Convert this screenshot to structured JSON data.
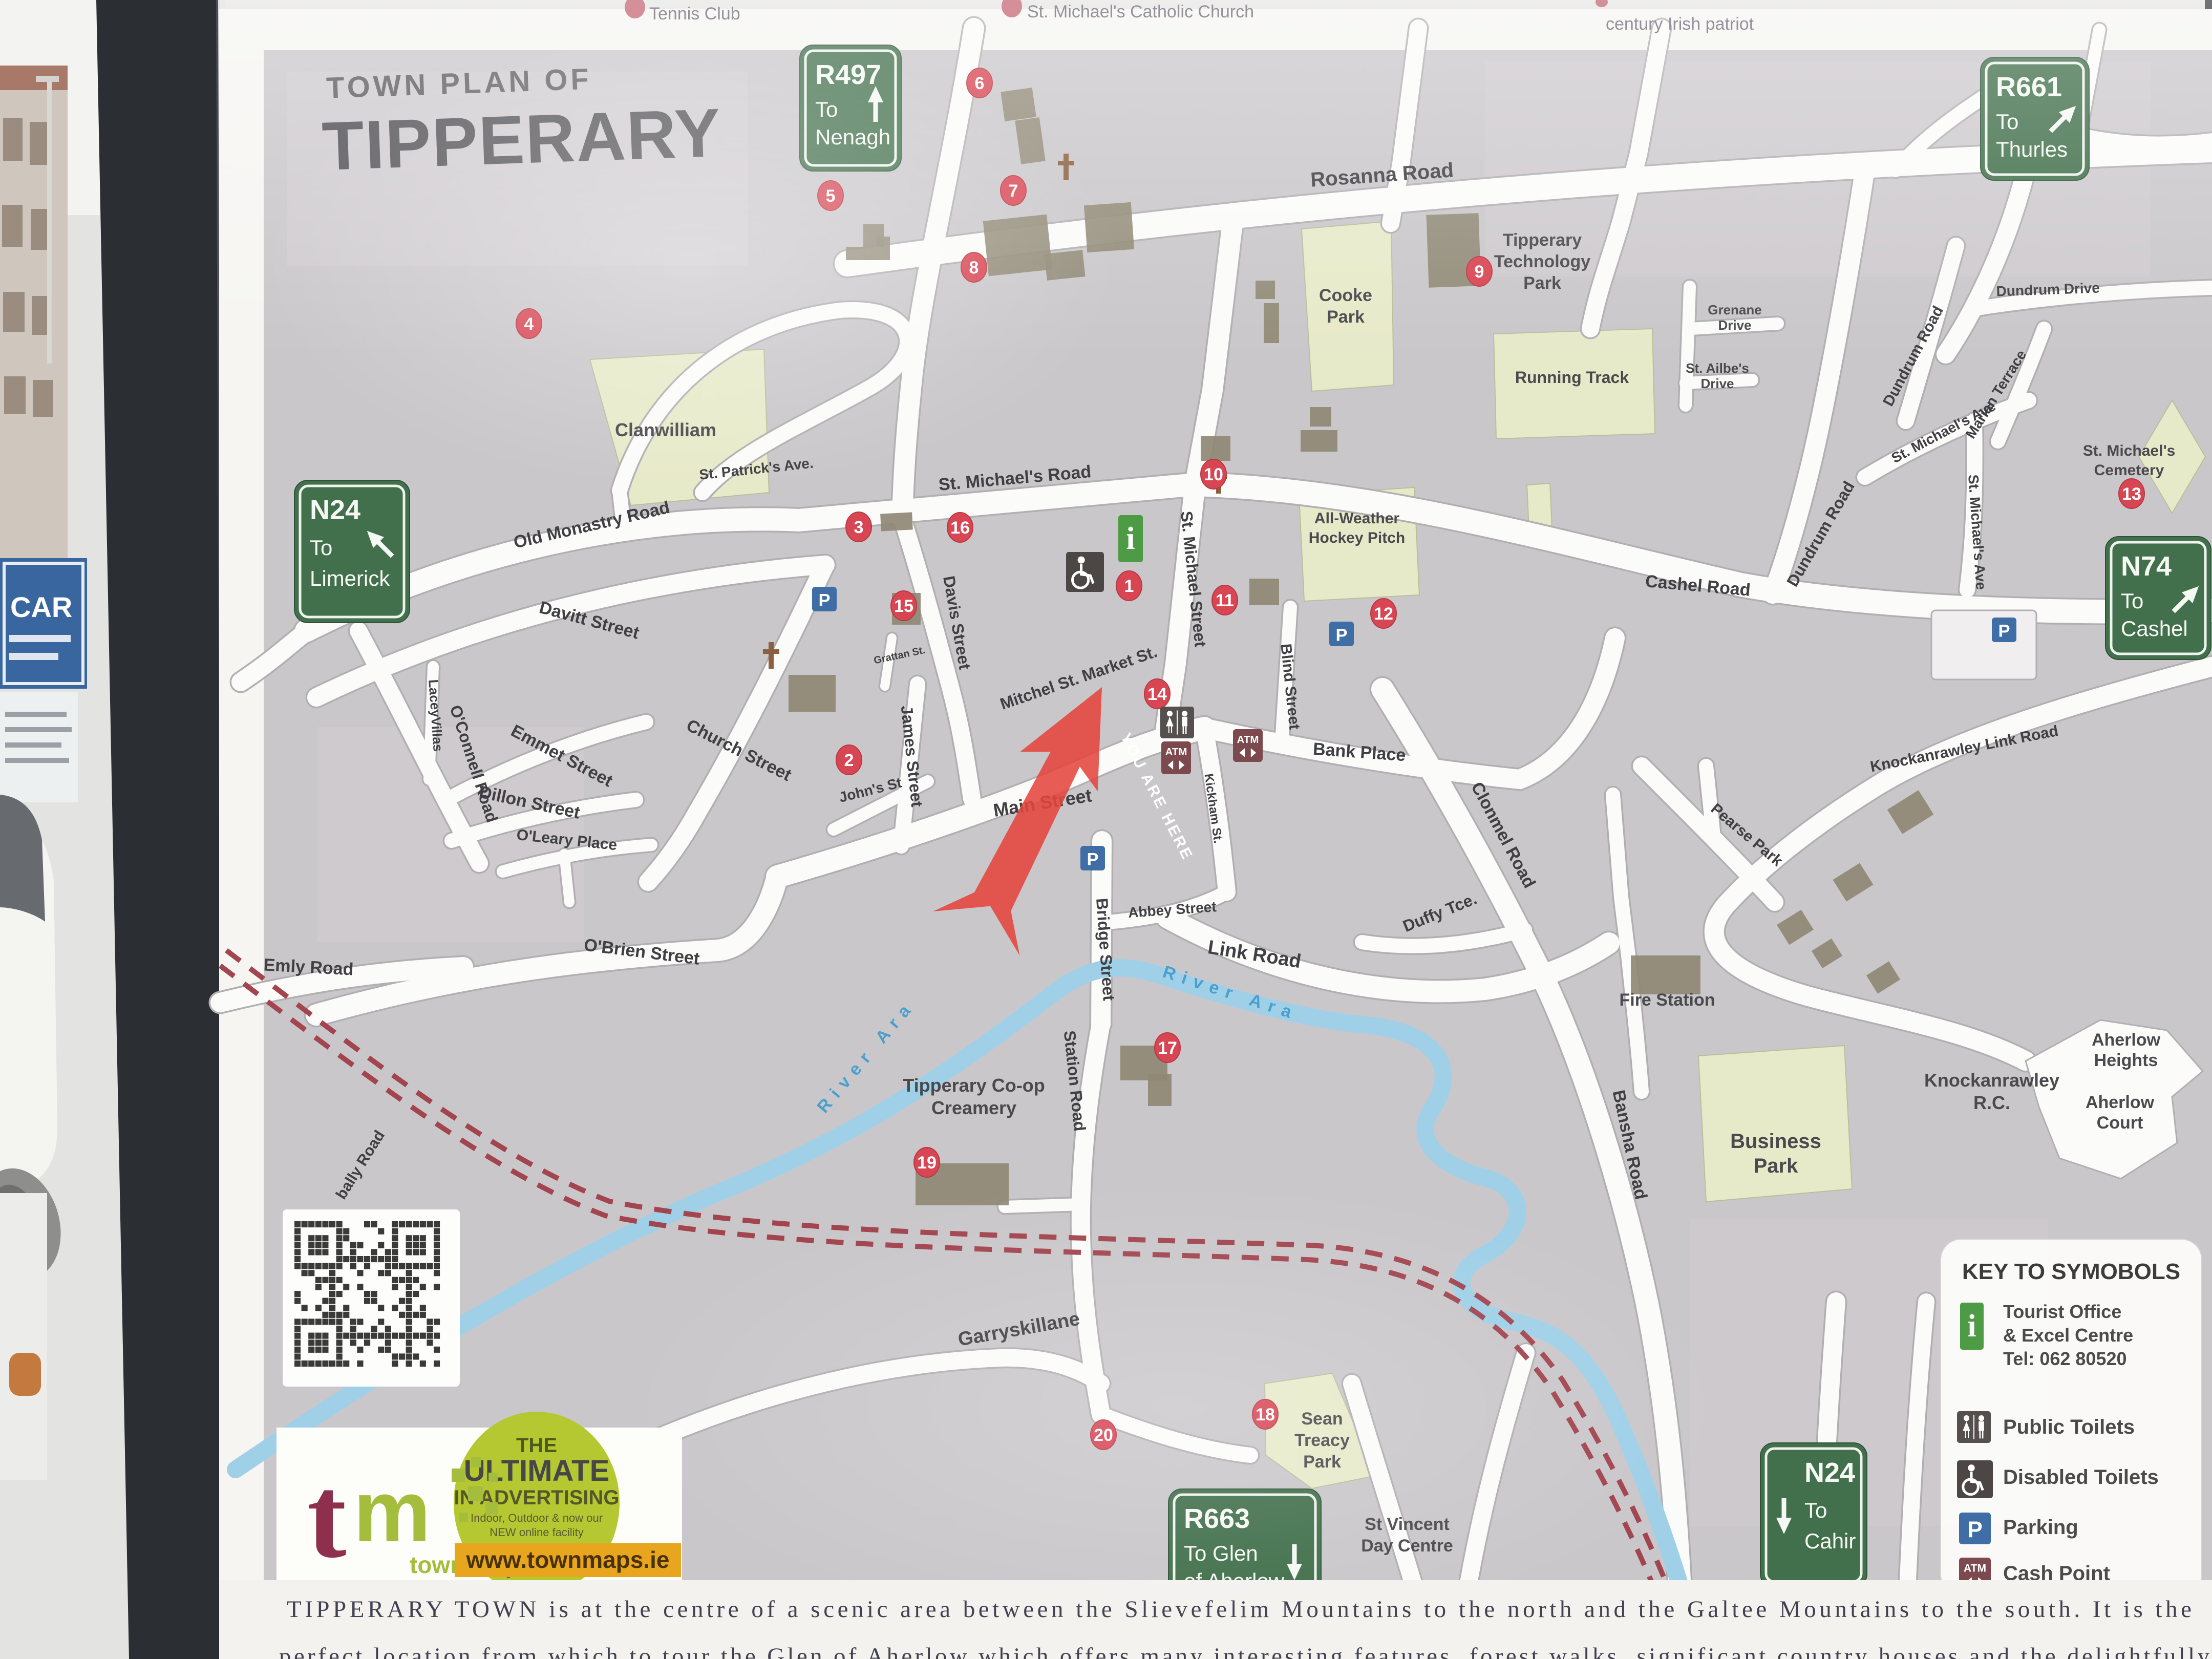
{
  "board": {
    "title_small": "TOWN PLAN OF",
    "title_large": "TIPPERARY",
    "top_cutoff_labels": [
      "Tennis Club",
      "St. Michael's Catholic Church",
      "century Irish patriot"
    ],
    "footer_line1": "TIPPERARY TOWN is at the centre of a scenic area between the Slievefelim Mountains to the north and the Galtee Mountains to the south. It is the",
    "footer_line2": "perfect location from which to tour the Glen of Aherlow which offers many interesting features, forest walks, significant country houses and the delightfully"
  },
  "you_are_here": "YOU ARE HERE",
  "road_signs": [
    {
      "ref": "R497",
      "dest": [
        "To",
        "Nenagh"
      ]
    },
    {
      "ref": "R661",
      "dest": [
        "To",
        "Thurles"
      ]
    },
    {
      "ref": "N24",
      "dest": [
        "To",
        "Limerick"
      ]
    },
    {
      "ref": "N74",
      "dest": [
        "To",
        "Cashel"
      ]
    },
    {
      "ref": "R663",
      "dest": [
        "To Glen",
        "of Aherlow"
      ]
    },
    {
      "ref": "N24",
      "dest": [
        "To",
        "Cahir"
      ]
    }
  ],
  "streets": [
    {
      "name": "Rosanna Road"
    },
    {
      "name": "St. Patrick's Ave."
    },
    {
      "name": "St. Michael's Road"
    },
    {
      "name": "Old Monastry Road"
    },
    {
      "name": "Davitt Street"
    },
    {
      "name": "LaceyVillas"
    },
    {
      "name": "Church Street"
    },
    {
      "name": "Emmet Street"
    },
    {
      "name": "Dillon Street"
    },
    {
      "name": "O'Connell Road"
    },
    {
      "name": "O'Leary Place"
    },
    {
      "name": "O'Brien Street"
    },
    {
      "name": "Emly Road"
    },
    {
      "name": "bally Road"
    },
    {
      "name": "John's St"
    },
    {
      "name": "James Street"
    },
    {
      "name": "Grattan St."
    },
    {
      "name": "Davis Street"
    },
    {
      "name": "Main Street"
    },
    {
      "name": "Mitchel St. Market St."
    },
    {
      "name": "St. Michael Street"
    },
    {
      "name": "Blind Street"
    },
    {
      "name": "Bank Place"
    },
    {
      "name": "Bridge Street"
    },
    {
      "name": "Abbey Street"
    },
    {
      "name": "Link Road"
    },
    {
      "name": "Kickham St."
    },
    {
      "name": "Duffy Tce."
    },
    {
      "name": "Clonmel Road"
    },
    {
      "name": "Cashel Road"
    },
    {
      "name": "Knockanrawley Link Road"
    },
    {
      "name": "Pearse Park"
    },
    {
      "name": "Dundrum Road"
    },
    {
      "name": "Dundrum Road"
    },
    {
      "name": "Dundrum Drive"
    },
    {
      "name": "St. Michael's Ave"
    },
    {
      "name": "St. Michael's Ave"
    },
    {
      "name": "Marian Terrace"
    },
    {
      "name": "Station Road"
    },
    {
      "name": "Bansha Road"
    },
    {
      "name": "Garryskillane"
    }
  ],
  "landmarks": [
    {
      "lines": [
        "Clanwilliam"
      ]
    },
    {
      "lines": [
        "Cooke",
        "Park"
      ]
    },
    {
      "lines": [
        "Running Track"
      ]
    },
    {
      "lines": [
        "All-Weather",
        "Hockey Pitch"
      ]
    },
    {
      "lines": [
        "Tipperary",
        "Technology",
        "Park"
      ]
    },
    {
      "lines": [
        "St. Michael's",
        "Cemetery"
      ]
    },
    {
      "lines": [
        "Tipperary Co-op",
        "Creamery"
      ]
    },
    {
      "lines": [
        "Fire Station"
      ]
    },
    {
      "lines": [
        "Business",
        "Park"
      ]
    },
    {
      "lines": [
        "Knockanrawley",
        "R.C."
      ]
    },
    {
      "lines": [
        "Aherlow",
        "Heights"
      ]
    },
    {
      "lines": [
        "Aherlow",
        "Court"
      ]
    },
    {
      "lines": [
        "Sean",
        "Treacy",
        "Park"
      ]
    },
    {
      "lines": [
        "St Vincent",
        "Day Centre"
      ]
    },
    {
      "lines": [
        "Grenane",
        "Drive"
      ]
    },
    {
      "lines": [
        "St. Ailbe's",
        "Drive"
      ]
    }
  ],
  "river_labels": [
    "River Ara",
    "River Ara"
  ],
  "markers": [
    {
      "n": "1"
    },
    {
      "n": "2"
    },
    {
      "n": "3"
    },
    {
      "n": "4"
    },
    {
      "n": "5"
    },
    {
      "n": "6"
    },
    {
      "n": "7"
    },
    {
      "n": "8"
    },
    {
      "n": "9"
    },
    {
      "n": "10"
    },
    {
      "n": "11"
    },
    {
      "n": "12"
    },
    {
      "n": "13"
    },
    {
      "n": "14"
    },
    {
      "n": "15"
    },
    {
      "n": "16"
    },
    {
      "n": "17"
    },
    {
      "n": "18"
    },
    {
      "n": "19"
    },
    {
      "n": "20"
    }
  ],
  "legend": {
    "title": "KEY TO SYMOBOLS",
    "items": [
      {
        "icon": "tourist-info-icon",
        "lines": [
          "Tourist Office",
          "& Excel Centre",
          "Tel: 062 80520"
        ]
      },
      {
        "icon": "public-toilets-icon",
        "lines": [
          "Public Toilets"
        ]
      },
      {
        "icon": "disabled-toilets-icon",
        "lines": [
          "Disabled Toilets"
        ]
      },
      {
        "icon": "parking-icon",
        "lines": [
          "Parking"
        ]
      },
      {
        "icon": "cash-point-icon",
        "lines": [
          "Cash Point"
        ]
      }
    ]
  },
  "branding": {
    "logo_t": "t",
    "logo_m": "m",
    "logo_sub_town": "town",
    "logo_sub_maps": "maps.ie",
    "oval_line1": "THE",
    "oval_line2": "ULTIMATE",
    "oval_line3": "IN ADVERTISING",
    "oval_line4": "Indoor, Outdoor & now our",
    "oval_line5": "NEW online facility",
    "url": "www.townmaps.ie"
  },
  "photo": {
    "blue_sign_text": "CAR"
  },
  "icon_glyphs": {
    "parking": "P",
    "atm": "ATM",
    "info": "i"
  },
  "colors": {
    "marker_red": "#d84653",
    "sign_green": "#42704c",
    "parking_blue": "#3f6da6",
    "atm_maroon": "#7c4a4e",
    "info_green": "#4d9b44",
    "river_blue": "#9fd0e8",
    "park_green": "#e7eac9",
    "railway_red": "#a2454f",
    "arrow_red": "#e4453c"
  }
}
